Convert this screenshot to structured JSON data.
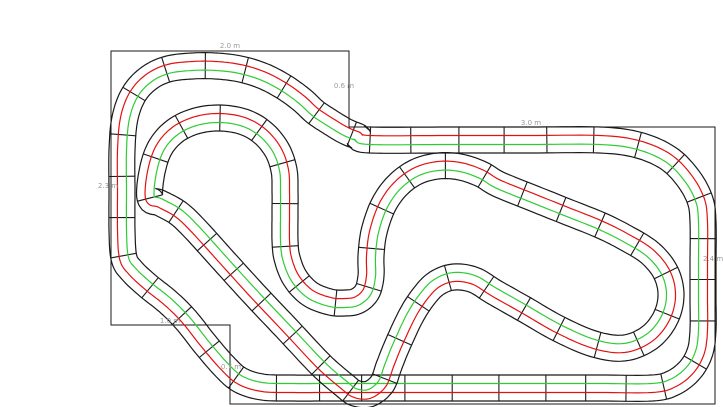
{
  "canvas": {
    "width": 723,
    "height": 407,
    "background": "#ffffff"
  },
  "table_outline": {
    "color": "#1a1a1a",
    "points": [
      [
        111,
        51
      ],
      [
        349,
        51
      ],
      [
        349,
        127
      ],
      [
        715,
        127
      ],
      [
        715,
        404
      ],
      [
        230,
        404
      ],
      [
        230,
        325
      ],
      [
        111,
        325
      ]
    ]
  },
  "dimension_labels": [
    {
      "text": "2.0 m",
      "x": 230,
      "y": 48,
      "anchor": "middle"
    },
    {
      "text": "0.6 m",
      "x": 344,
      "y": 88,
      "anchor": "middle"
    },
    {
      "text": "3.0 m",
      "x": 531,
      "y": 125,
      "anchor": "middle"
    },
    {
      "text": "2.4 m",
      "x": 703,
      "y": 261,
      "anchor": "start"
    },
    {
      "text": "2.3 m",
      "x": 108,
      "y": 188,
      "anchor": "middle"
    },
    {
      "text": "1.0 m",
      "x": 170,
      "y": 323,
      "anchor": "middle"
    },
    {
      "text": "0.7 m",
      "x": 231,
      "y": 369,
      "anchor": "middle"
    }
  ],
  "label_style": {
    "color": "#9a9a9a",
    "size": 7
  },
  "track": {
    "border_color": "#1a1a1a",
    "lane_left_color": "#e31212",
    "lane_right_color": "#2ecc33",
    "half_width": 13,
    "lane_offset": 4.5,
    "tie_spacing": 40,
    "pieces": [
      {
        "name": "outer-loop",
        "closed": true,
        "points": [
          [
            370,
            140
          ],
          [
            450,
            140
          ],
          [
            530,
            140
          ],
          [
            600,
            140
          ],
          [
            638,
            145
          ],
          [
            668,
            158
          ],
          [
            688,
            178
          ],
          [
            700,
            200
          ],
          [
            703,
            222
          ],
          [
            703,
            262
          ],
          [
            703,
            300
          ],
          [
            703,
            330
          ],
          [
            700,
            352
          ],
          [
            690,
            370
          ],
          [
            673,
            383
          ],
          [
            652,
            388
          ],
          [
            600,
            388
          ],
          [
            530,
            388
          ],
          [
            460,
            388
          ],
          [
            390,
            388
          ],
          [
            330,
            388
          ],
          [
            290,
            388
          ],
          [
            262,
            387
          ],
          [
            240,
            380
          ],
          [
            224,
            366
          ],
          [
            205,
            344
          ],
          [
            186,
            320
          ],
          [
            168,
            302
          ],
          [
            148,
            286
          ],
          [
            132,
            271
          ],
          [
            124,
            258
          ],
          [
            122,
            230
          ],
          [
            122,
            190
          ],
          [
            122,
            150
          ],
          [
            125,
            118
          ],
          [
            134,
            94
          ],
          [
            149,
            78
          ],
          [
            168,
            69
          ],
          [
            192,
            66
          ],
          [
            216,
            66
          ],
          [
            240,
            69
          ],
          [
            263,
            76
          ],
          [
            284,
            87
          ],
          [
            302,
            100
          ],
          [
            315,
            112
          ],
          [
            330,
            122
          ],
          [
            345,
            131
          ],
          [
            357,
            136
          ]
        ]
      },
      {
        "name": "inner-loop",
        "closed": true,
        "points": [
          [
            150,
            198
          ],
          [
            152,
            172
          ],
          [
            160,
            148
          ],
          [
            175,
            131
          ],
          [
            196,
            121
          ],
          [
            220,
            118
          ],
          [
            244,
            122
          ],
          [
            263,
            133
          ],
          [
            277,
            150
          ],
          [
            284,
            170
          ],
          [
            285,
            190
          ],
          [
            285,
            215
          ],
          [
            285,
            240
          ],
          [
            287,
            258
          ],
          [
            295,
            278
          ],
          [
            310,
            294
          ],
          [
            330,
            302
          ],
          [
            345,
            303
          ],
          [
            357,
            301
          ],
          [
            367,
            292
          ],
          [
            371,
            276
          ],
          [
            371,
            256
          ],
          [
            374,
            232
          ],
          [
            383,
            206
          ],
          [
            397,
            186
          ],
          [
            416,
            172
          ],
          [
            438,
            166
          ],
          [
            460,
            167
          ],
          [
            481,
            174
          ],
          [
            498,
            184
          ],
          [
            530,
            197
          ],
          [
            565,
            211
          ],
          [
            600,
            225
          ],
          [
            626,
            238
          ],
          [
            650,
            253
          ],
          [
            666,
            273
          ],
          [
            671,
            296
          ],
          [
            665,
            319
          ],
          [
            649,
            338
          ],
          [
            624,
            348
          ],
          [
            594,
            344
          ],
          [
            559,
            329
          ],
          [
            524,
            309
          ],
          [
            494,
            292
          ],
          [
            474,
            280
          ],
          [
            454,
            277
          ],
          [
            437,
            283
          ],
          [
            424,
            296
          ],
          [
            411,
            316
          ],
          [
            397,
            346
          ],
          [
            389,
            366
          ],
          [
            382,
            384
          ],
          [
            369,
            394
          ],
          [
            355,
            393
          ],
          [
            344,
            385
          ],
          [
            321,
            365
          ],
          [
            289,
            331
          ],
          [
            254,
            294
          ],
          [
            224,
            261
          ],
          [
            195,
            229
          ],
          [
            178,
            213
          ],
          [
            160,
            203
          ]
        ]
      }
    ]
  }
}
